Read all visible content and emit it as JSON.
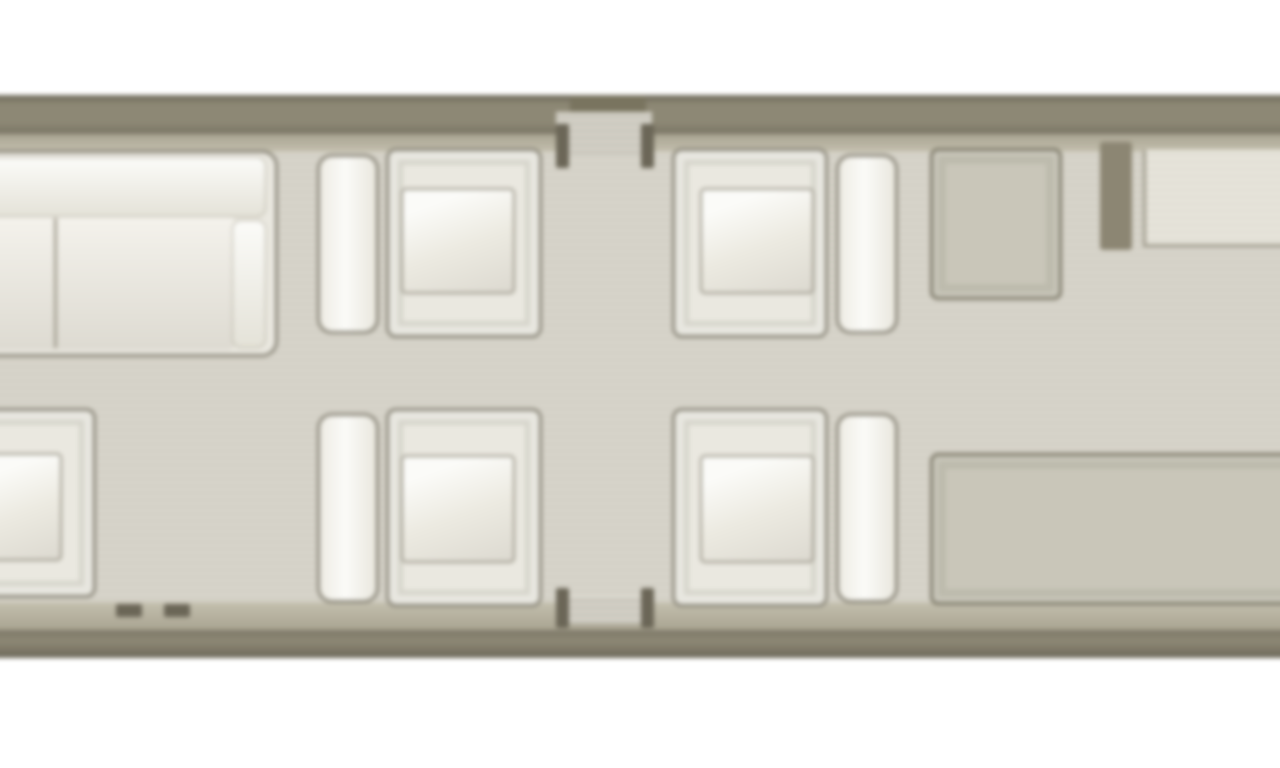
{
  "meta": {
    "description": "Private aircraft cabin floor plan diagram, top-down view, no text labels",
    "canvas": {
      "width": 1280,
      "height": 768
    },
    "blur_px": 2.3
  },
  "palette": {
    "background": "#ffffff",
    "wall": "#8d8875",
    "wall_edge": "#6d6859",
    "lining": "#c3bfae",
    "floor": "#d6d3c9",
    "floor_stripe": "#d1cec4",
    "furniture_fill": "#eae8e0",
    "furniture_border": "#8b877a",
    "cushion_bright": "#fbfbf8",
    "cushion_shade": "#dcd9d0",
    "grey_fill": "#c9c6b9",
    "grey_border": "#7e7a69",
    "partition": "#8c8673",
    "door_mark": "#6b6657"
  },
  "scene": {
    "elements": [
      {
        "name": "fuselage-wall-top",
        "type": "wall-top",
        "x": -40,
        "y": 95,
        "w": 1360,
        "h": 39
      },
      {
        "name": "fuselage-lining-top",
        "type": "lining-top",
        "x": -40,
        "y": 134,
        "w": 1360,
        "h": 18
      },
      {
        "name": "cabin-floor",
        "type": "floor",
        "x": -40,
        "y": 152,
        "w": 1360,
        "h": 450
      },
      {
        "name": "fuselage-lining-bottom",
        "type": "lining-bottom",
        "x": -40,
        "y": 602,
        "w": 1360,
        "h": 28
      },
      {
        "name": "fuselage-wall-bottom",
        "type": "wall-bottom",
        "x": -40,
        "y": 630,
        "w": 1360,
        "h": 28
      },
      {
        "name": "door-opening-top",
        "type": "door-shadow",
        "x": 570,
        "y": 96,
        "w": 76,
        "h": 22
      },
      {
        "name": "entry-door-carpet-top",
        "type": "door-carpet",
        "x": 556,
        "y": 112,
        "w": 96,
        "h": 42
      },
      {
        "name": "entry-door-carpet-bottom",
        "type": "door-carpet",
        "x": 556,
        "y": 596,
        "w": 96,
        "h": 28
      },
      {
        "name": "door-frame-post-top-left",
        "type": "door-post",
        "x": 556,
        "y": 124,
        "w": 13,
        "h": 44
      },
      {
        "name": "door-frame-post-top-right",
        "type": "door-post",
        "x": 641,
        "y": 124,
        "w": 13,
        "h": 44
      },
      {
        "name": "door-frame-post-bottom-left",
        "type": "door-post",
        "x": 556,
        "y": 588,
        "w": 13,
        "h": 40
      },
      {
        "name": "door-frame-post-bottom-right",
        "type": "door-post",
        "x": 641,
        "y": 588,
        "w": 13,
        "h": 40
      },
      {
        "name": "exit-mark-left",
        "type": "tick",
        "x": 116,
        "y": 604,
        "w": 26,
        "h": 13
      },
      {
        "name": "exit-mark-right",
        "type": "tick",
        "x": 164,
        "y": 604,
        "w": 26,
        "h": 13
      },
      {
        "name": "divan-sofa",
        "type": "sofa",
        "x": -44,
        "y": 150,
        "w": 322,
        "h": 207
      },
      {
        "name": "divan-sofa-seat",
        "type": "sofa-part-seat",
        "x": -36,
        "y": 216,
        "w": 270,
        "h": 134
      },
      {
        "name": "divan-sofa-divider",
        "type": "sofa-divider",
        "x": 54,
        "y": 218,
        "w": 3,
        "h": 130
      },
      {
        "name": "divan-sofa-backrest",
        "type": "sofa-part-back",
        "x": -36,
        "y": 157,
        "w": 302,
        "h": 60
      },
      {
        "name": "divan-sofa-armrest",
        "type": "sofa-part-arm",
        "x": 232,
        "y": 220,
        "w": 34,
        "h": 128
      },
      {
        "name": "seat-back-forward-left",
        "type": "seatback",
        "x": 317,
        "y": 154,
        "w": 62,
        "h": 180
      },
      {
        "name": "club-chair-forward-left",
        "type": "chair",
        "x": 386,
        "y": 148,
        "w": 156,
        "h": 190
      },
      {
        "name": "club-chair-forward-left-cushion",
        "type": "cushion",
        "x": 401,
        "y": 188,
        "w": 114,
        "h": 106
      },
      {
        "name": "club-chair-forward-right",
        "type": "chair",
        "x": 672,
        "y": 148,
        "w": 156,
        "h": 190
      },
      {
        "name": "club-chair-forward-right-cushion",
        "type": "cushion",
        "x": 700,
        "y": 188,
        "w": 114,
        "h": 106
      },
      {
        "name": "seat-back-forward-right",
        "type": "seatback",
        "x": 836,
        "y": 154,
        "w": 62,
        "h": 180
      },
      {
        "name": "cabinet-table",
        "type": "greybox",
        "x": 930,
        "y": 148,
        "w": 132,
        "h": 152
      },
      {
        "name": "partition-wall",
        "type": "partition",
        "x": 1100,
        "y": 142,
        "w": 32,
        "h": 108
      },
      {
        "name": "galley-counter",
        "type": "counter",
        "x": 1143,
        "y": 150,
        "w": 181,
        "h": 97
      },
      {
        "name": "club-chair-aft-edge",
        "type": "chair",
        "x": -62,
        "y": 408,
        "w": 158,
        "h": 190
      },
      {
        "name": "club-chair-aft-edge-cushion",
        "type": "cushion",
        "x": -22,
        "y": 453,
        "w": 84,
        "h": 108
      },
      {
        "name": "seat-back-aft-left",
        "type": "seatback",
        "x": 317,
        "y": 413,
        "w": 62,
        "h": 190
      },
      {
        "name": "club-chair-aft-left",
        "type": "chair",
        "x": 386,
        "y": 408,
        "w": 156,
        "h": 199
      },
      {
        "name": "club-chair-aft-left-cushion",
        "type": "cushion",
        "x": 401,
        "y": 455,
        "w": 114,
        "h": 108
      },
      {
        "name": "club-chair-aft-right",
        "type": "chair",
        "x": 672,
        "y": 408,
        "w": 156,
        "h": 199
      },
      {
        "name": "club-chair-aft-right-cushion",
        "type": "cushion",
        "x": 700,
        "y": 455,
        "w": 114,
        "h": 108
      },
      {
        "name": "seat-back-aft-right",
        "type": "seatback",
        "x": 836,
        "y": 413,
        "w": 62,
        "h": 190
      },
      {
        "name": "credenza",
        "type": "greybox",
        "x": 930,
        "y": 453,
        "w": 394,
        "h": 152
      }
    ]
  }
}
